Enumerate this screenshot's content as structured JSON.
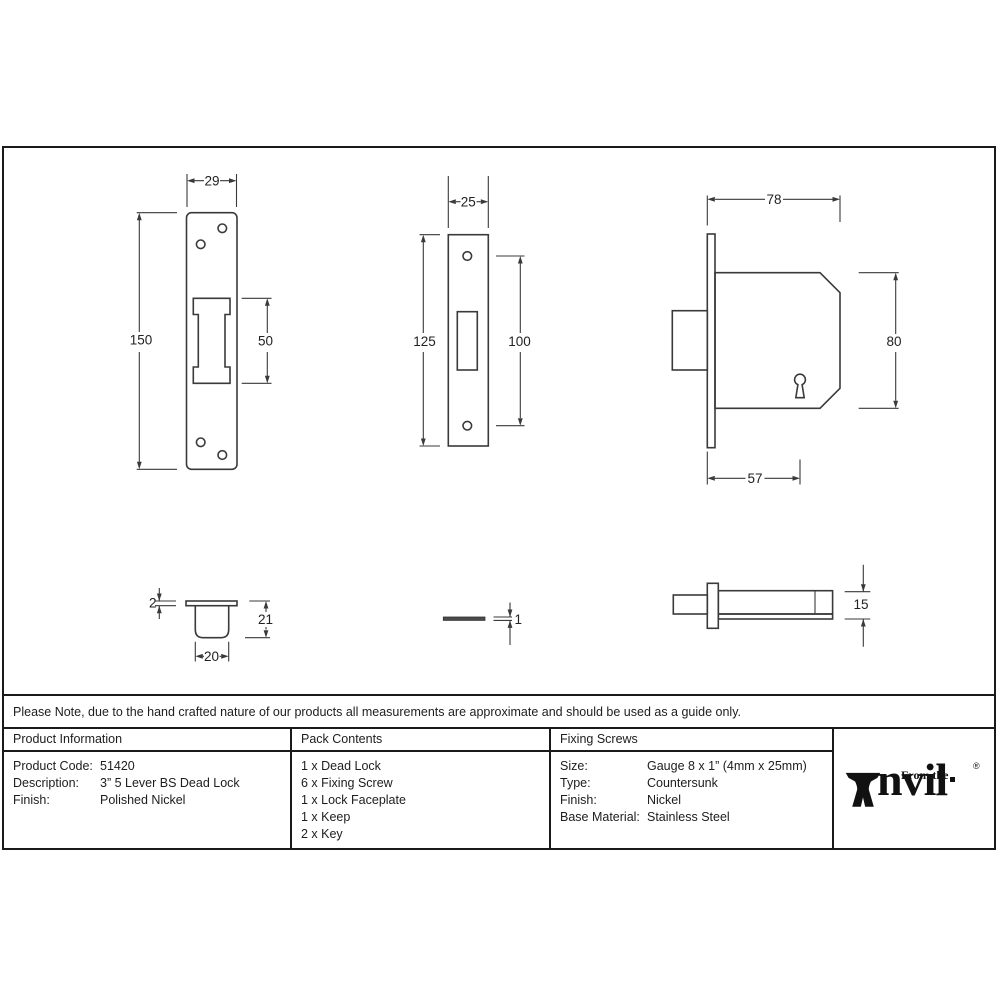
{
  "note": "Please Note, due to the hand crafted nature of our products all measurements are approximate and should be used as a guide only.",
  "drawings": {
    "faceplate_front": {
      "width": "29",
      "height": "150",
      "cutout": "50"
    },
    "keep_plate": {
      "width": "25",
      "height": "125",
      "hole_spacing": "100"
    },
    "lock_body": {
      "width": "78",
      "height": "80",
      "backset": "57"
    },
    "keep_section": {
      "flange": "2",
      "depth": "21",
      "width": "20"
    },
    "faceplate_side": {
      "thickness": "1"
    },
    "lock_side": {
      "height": "15"
    }
  },
  "table": {
    "product_information": {
      "header": "Product Information",
      "rows": [
        {
          "label": "Product Code:",
          "value": "51420"
        },
        {
          "label": "Description:",
          "value": "3” 5 Lever BS Dead Lock"
        },
        {
          "label": "Finish:",
          "value": "Polished Nickel"
        }
      ]
    },
    "pack_contents": {
      "header": "Pack Contents",
      "items": [
        "1 x Dead Lock",
        "6 x Fixing Screw",
        "1 x Lock Faceplate",
        "1 x Keep",
        "2 x Key"
      ]
    },
    "fixing_screws": {
      "header": "Fixing Screws",
      "rows": [
        {
          "label": "Size:",
          "value": "Gauge 8 x 1” (4mm x 25mm)"
        },
        {
          "label": "Type:",
          "value": "Countersunk"
        },
        {
          "label": "Finish:",
          "value": "Nickel"
        },
        {
          "label": "Base Material:",
          "value": "Stainless Steel"
        }
      ]
    }
  },
  "logo": {
    "prefix": "From the",
    "wordmark_rest": "nvil",
    "registered": "®"
  }
}
